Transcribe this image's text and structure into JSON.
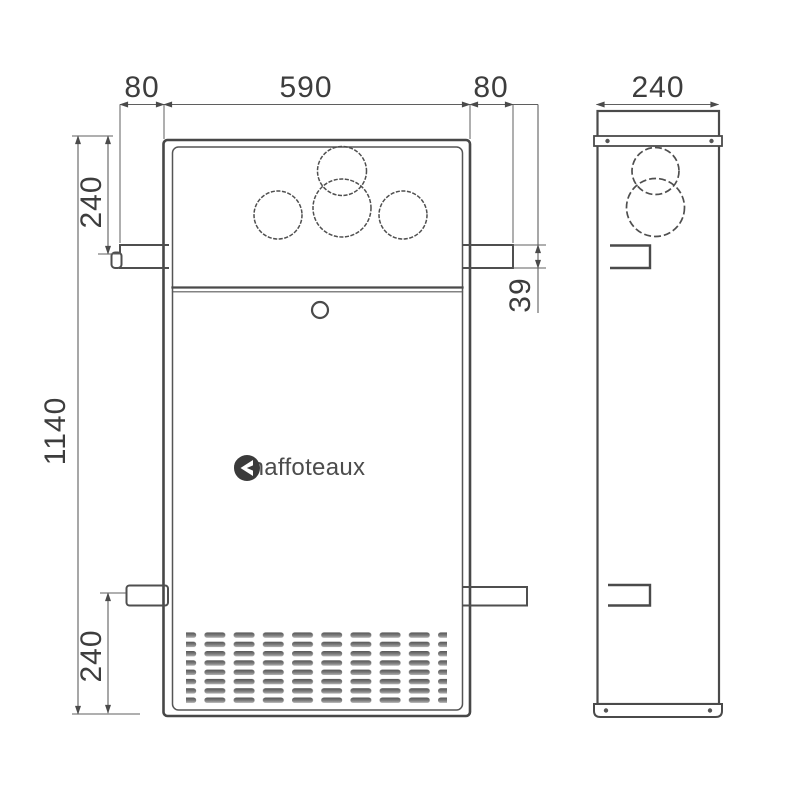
{
  "drawing": {
    "logo": {
      "brand": "Chaffoteaux"
    },
    "dimensions": {
      "top_left_offset": "80",
      "body_width": "590",
      "top_right_offset": "80",
      "side_depth": "240",
      "total_height": "1140",
      "upper_bracket_offset": "240",
      "lower_bracket_offset": "240",
      "bracket_height": "39"
    }
  }
}
